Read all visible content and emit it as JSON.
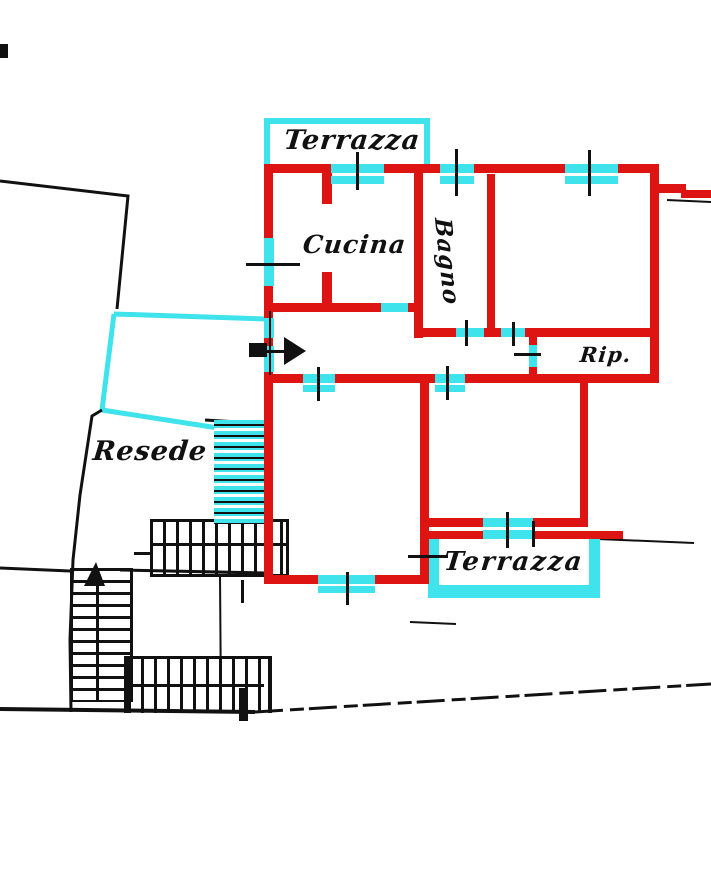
{
  "plan": {
    "rooms": {
      "terrazza_top": "Terrazza",
      "cucina": "Cucina",
      "bagno": "Bagno",
      "rip": "Rip.",
      "resede": "Resede",
      "terrazza_bottom": "Terrazza"
    },
    "colors": {
      "wall": "#dd1411",
      "highlight": "#3fe3ec",
      "ink": "#111111",
      "background": "#ffffff"
    }
  }
}
